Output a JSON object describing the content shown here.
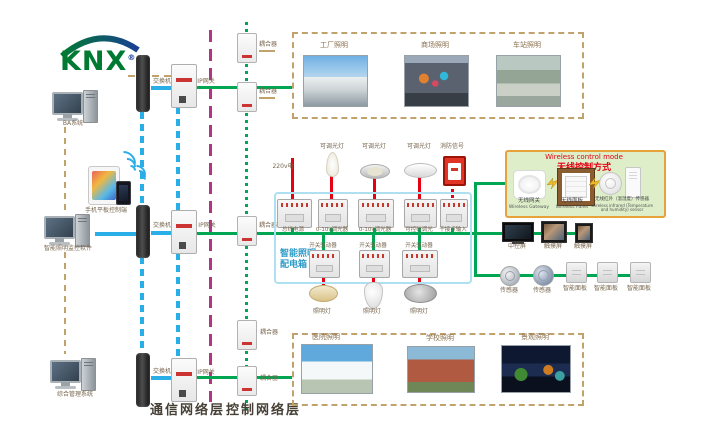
{
  "brand": {
    "logo_text": "KNX",
    "registered": "®"
  },
  "layers": {
    "communication": "通信网络层",
    "control": "控制网络层"
  },
  "left": {
    "computers": [
      {
        "label": "BA系统"
      },
      {
        "label": "智能照明监控软件"
      },
      {
        "label": "综合管理系统"
      }
    ],
    "mobile_label": "手机平板控制端"
  },
  "network": {
    "switches": [
      "交换机",
      "交换机",
      "交换机"
    ],
    "gateways": [
      "IP网关",
      "IP网关",
      "IP网关"
    ],
    "couplers": [
      "耦合器",
      "耦合器",
      "耦合器",
      "耦合器",
      "耦合器"
    ]
  },
  "top_gallery": {
    "items": [
      {
        "label": "工厂照明"
      },
      {
        "label": "商场照明"
      },
      {
        "label": "车站照明"
      }
    ]
  },
  "bottom_gallery": {
    "items": [
      {
        "label": "医院照明"
      },
      {
        "label": "学校照明"
      },
      {
        "label": "景观照明"
      }
    ]
  },
  "panel": {
    "box_title_1": "智能照明",
    "box_title_2": "配电箱",
    "power_label": "220v电",
    "dim_lights": [
      "可调光灯",
      "可调光灯",
      "可调光灯"
    ],
    "fire_label": "消防信号",
    "top_modules": [
      "总线电源",
      "0-10v调光器",
      "0-10v调光器",
      "可控硅调光",
      "干接点输入"
    ],
    "actuators": [
      "开关驱动器",
      "开关驱动器",
      "开关驱动器"
    ],
    "lamps": [
      "照明灯",
      "照明灯",
      "照明灯"
    ]
  },
  "wireless": {
    "title_en": "Wireless control mode",
    "title_zh": "无线控制方式",
    "items": [
      {
        "zh": "无线网关",
        "en": "Wireless Gateway"
      },
      {
        "zh": "无线面板",
        "en": "Wireless Panel"
      },
      {
        "zh": "无线红外（温湿度）传感器",
        "en": "Wireless infrared (Temperature and humidity) sensor"
      }
    ]
  },
  "right": {
    "screens": [
      "中控屏",
      "触摸屏",
      "触摸屏"
    ],
    "sensors": [
      "传感器",
      "传感器"
    ],
    "panels": [
      "智能面板",
      "智能面板",
      "智能面板"
    ]
  },
  "colors": {
    "line_green": "#00a651",
    "line_blue": "#2aaee8",
    "line_purple": "#b13584",
    "line_tan": "#c2a26c",
    "line_red": "#e60012",
    "panel_border": "#aee0f2",
    "wireless_bg": "#ddeec9",
    "wireless_border": "#e8a23c",
    "knx_green": "#007a33",
    "knx_blue": "#1b3f94"
  }
}
